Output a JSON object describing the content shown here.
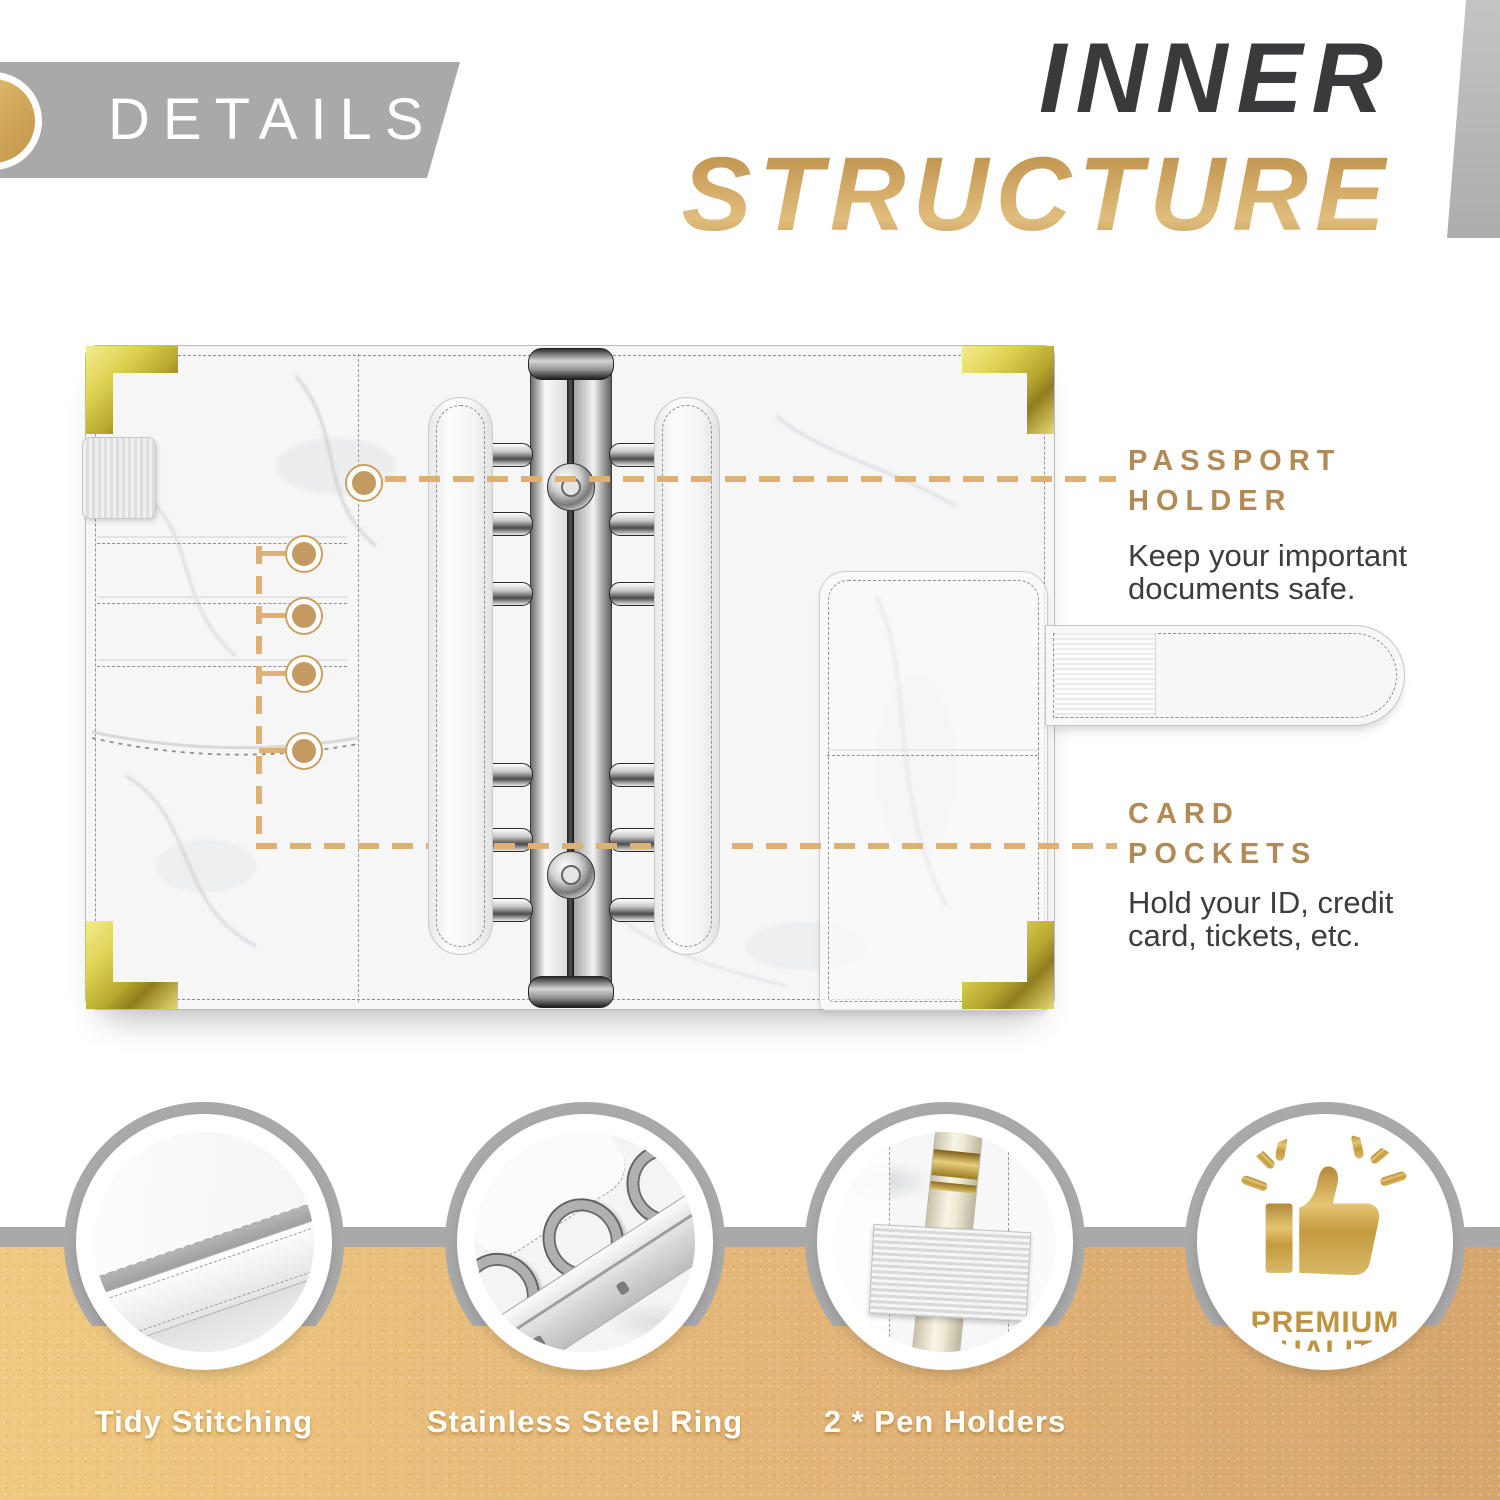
{
  "header": {
    "details_label": "DETAILS",
    "title_line1": "INNER",
    "title_line2": "STRUCTURE"
  },
  "callouts": {
    "passport": {
      "title_line1": "PASSPORT",
      "title_line2": "HOLDER",
      "desc_line1": "Keep your important",
      "desc_line2": "documents safe."
    },
    "card_pockets": {
      "title_line1": "CARD",
      "title_line2": "POCKETS",
      "desc_line1": "Hold your ID, credit",
      "desc_line2": "card, tickets, etc."
    }
  },
  "features": [
    {
      "label": "Tidy Stitching"
    },
    {
      "label": "Stainless Steel Ring"
    },
    {
      "label": "2 * Pen Holders"
    }
  ],
  "badge": {
    "line1": "PREMIUM",
    "line2": "QUALITY",
    "icon": "thumbs-up-icon"
  },
  "colors": {
    "gold_title": "#c79d5c",
    "gold_heading": "#b28a55",
    "dark_text": "#3d3d3d",
    "banner_gray": "#a9a9a9",
    "band_tan": "#e8bf7a",
    "dash_gold": "#dcb076",
    "corner_gold": "#ded253"
  }
}
